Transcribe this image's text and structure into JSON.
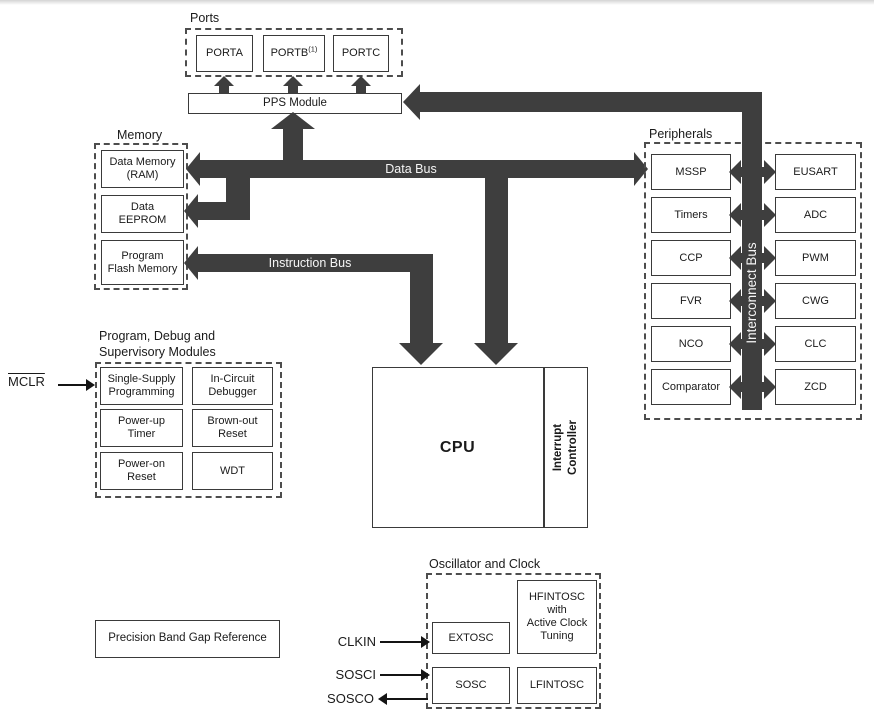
{
  "colors": {
    "bus": "#3e3e3e",
    "box_border": "#3a3a3a",
    "ink": "#1a1a1a",
    "bus_text": "#f5f5f5",
    "background": "#ffffff"
  },
  "ports": {
    "title": "Ports",
    "porta": "PORTA",
    "portb": "PORTB",
    "portb_superscript": "(1)",
    "portc": "PORTC"
  },
  "pps": {
    "label": "PPS Module"
  },
  "buses": {
    "data_bus": "Data Bus",
    "instruction_bus": "Instruction Bus",
    "interconnect_bus": "Interconnect Bus"
  },
  "memory": {
    "title": "Memory",
    "ram": "Data Memory\n(RAM)",
    "eeprom": "Data\nEEPROM",
    "flash": "Program\nFlash Memory"
  },
  "peripherals": {
    "title": "Peripherals",
    "left": [
      "MSSP",
      "Timers",
      "CCP",
      "FVR",
      "NCO",
      "Comparator"
    ],
    "right": [
      "EUSART",
      "ADC",
      "PWM",
      "CWG",
      "CLC",
      "ZCD"
    ]
  },
  "debug": {
    "title": "Program, Debug and\nSupervisory Modules",
    "mclr": "MCLR",
    "cells": [
      "Single-Supply\nProgramming",
      "In-Circuit\nDebugger",
      "Power-up\nTimer",
      "Brown-out\nReset",
      "Power-on\nReset",
      "WDT"
    ]
  },
  "cpu": {
    "label": "CPU",
    "interrupt_controller": "Interrupt\nController"
  },
  "bandgap": {
    "label": "Precision Band Gap Reference"
  },
  "oscillator": {
    "title": "Oscillator and Clock",
    "extosc": "EXTOSC",
    "hfintosc": "HFINTOSC\nwith\nActive Clock\nTuning",
    "sosc": "SOSC",
    "lfintosc": "LFINTOSC",
    "clkin": "CLKIN",
    "sosci": "SOSCI",
    "sosco": "SOSCO"
  }
}
